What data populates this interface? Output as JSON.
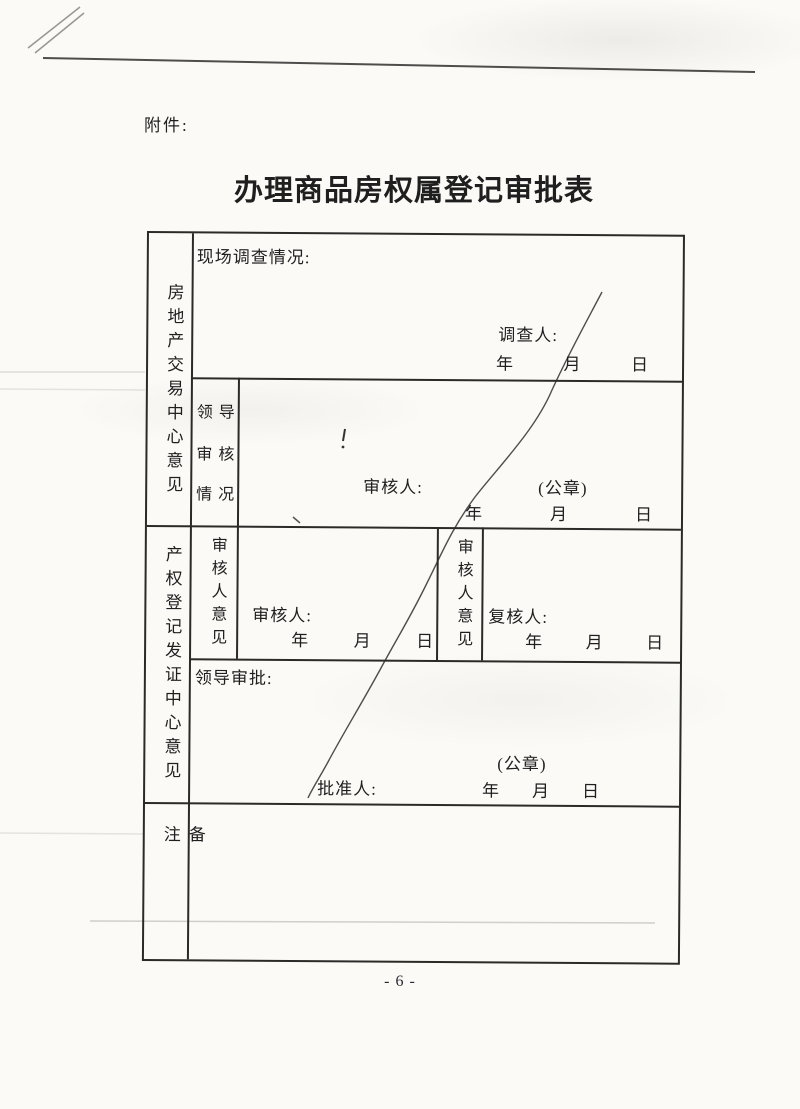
{
  "page": {
    "attachment_label": "附件:",
    "title": "办理商品房权属登记审批表",
    "page_number": "- 6 -"
  },
  "table": {
    "trade_center": {
      "section_label": "房地产交易中心意见",
      "site_survey": {
        "field_label": "现场调查情况:",
        "investigator_label": "调查人:",
        "date": {
          "year": "年",
          "month": "月",
          "day": "日"
        }
      },
      "leader_review": {
        "label_lines": [
          "领导",
          "审核",
          "情况"
        ],
        "reviewer_label": "审核人:",
        "seal_label": "(公章)",
        "date": {
          "year": "年",
          "month": "月",
          "day": "日"
        }
      }
    },
    "registration_center": {
      "section_label": "产权登记发证中心意见",
      "reviewer_opinion_left": {
        "label": "审核人意见",
        "reviewer_label": "审核人:",
        "date": {
          "year": "年",
          "month": "月",
          "day": "日"
        }
      },
      "reviewer_opinion_right": {
        "label": "审核人意见",
        "reviewer_label": "复核人:",
        "date": {
          "year": "年",
          "month": "月",
          "day": "日"
        }
      },
      "leader_approval": {
        "field_label": "领导审批:",
        "seal_label": "(公章)",
        "approver_label": "批准人:",
        "date": {
          "year": "年",
          "month": "月",
          "day": "日"
        }
      }
    },
    "remarks": {
      "section_label": "备注"
    }
  },
  "colors": {
    "paper": "#fbfaf7",
    "ink": "#1f1f1f",
    "border": "#2c2a28",
    "pen_stroke": "#3a3a3a"
  }
}
